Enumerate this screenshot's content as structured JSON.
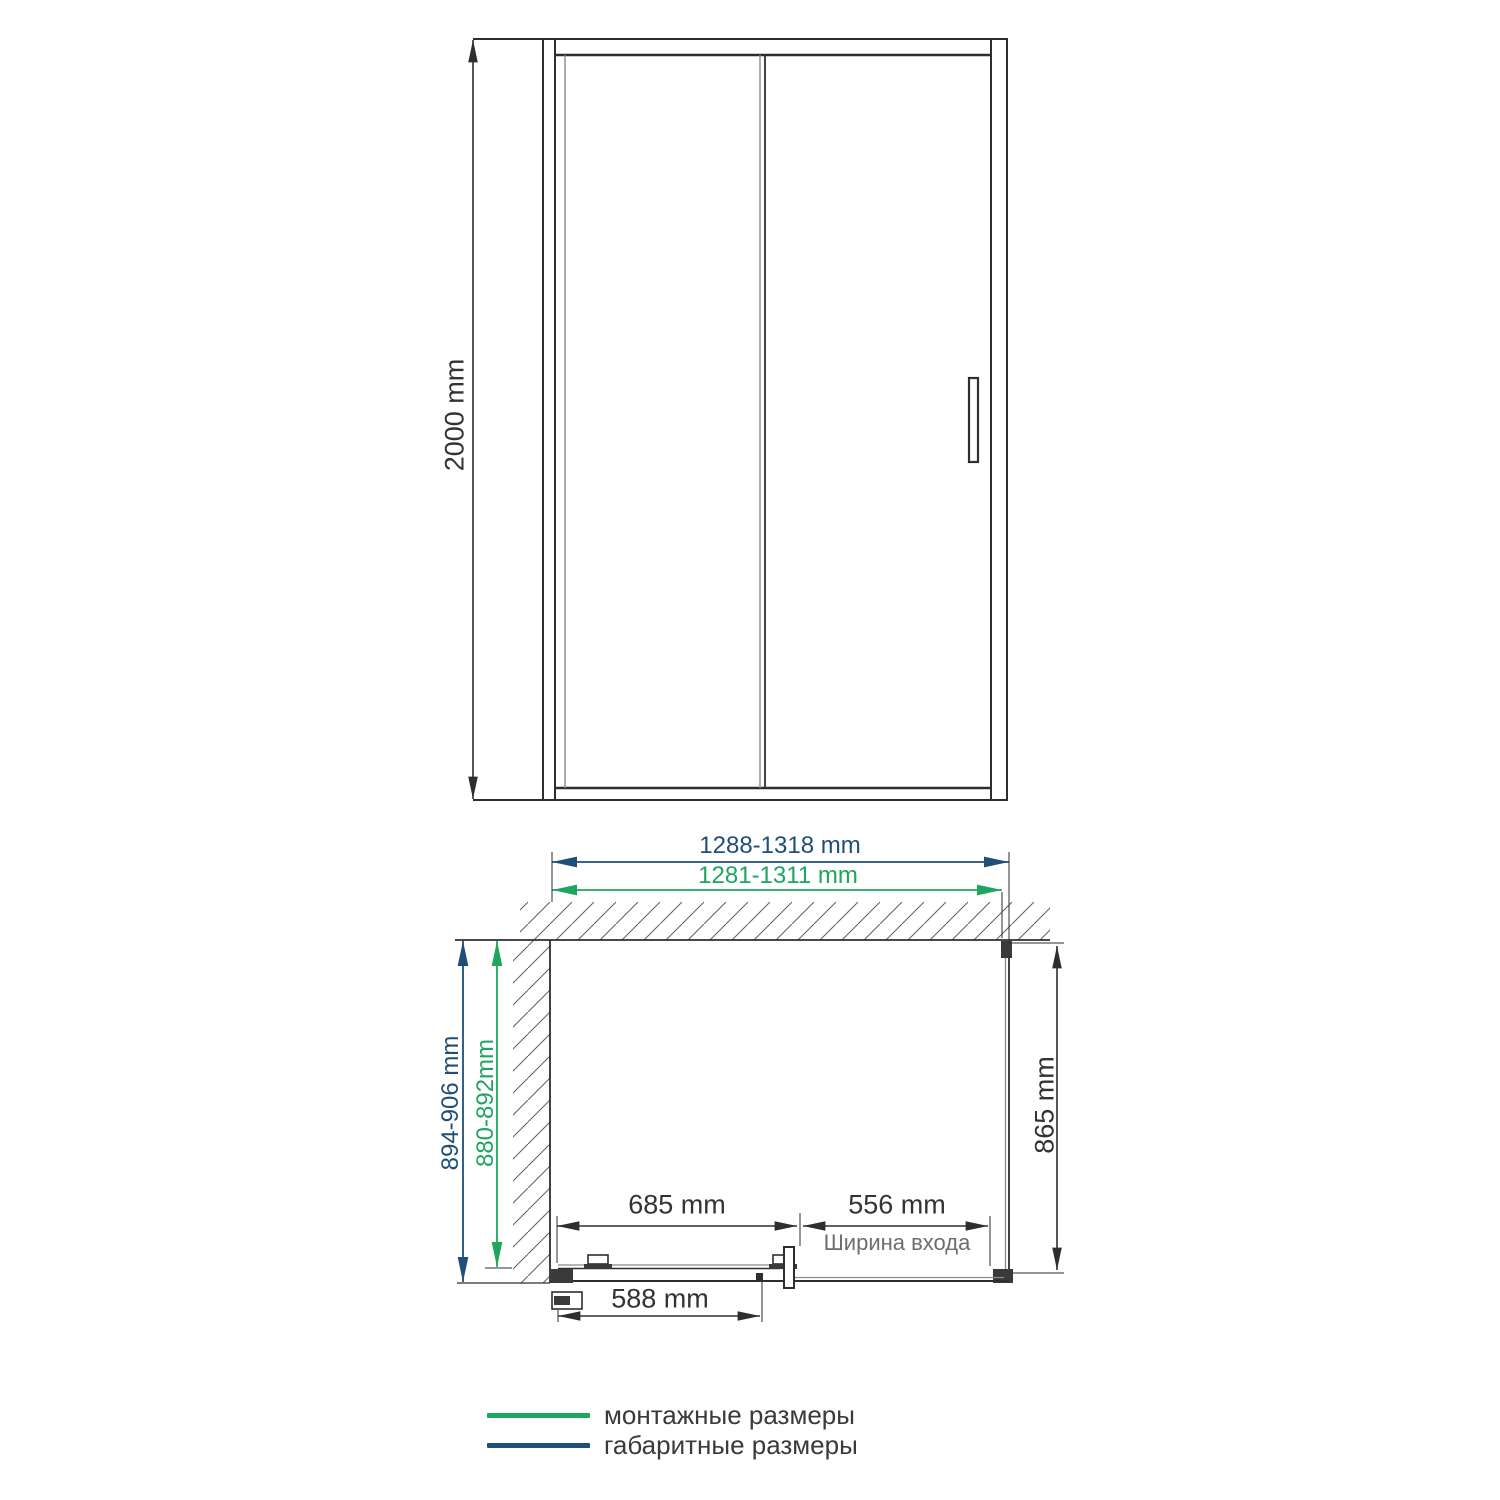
{
  "colors": {
    "overall": "#1F4E79",
    "mounting": "#1FA65E",
    "ink": "#2e2e2e",
    "muted": "#6e6e6e"
  },
  "front_view": {
    "height": "2000 mm"
  },
  "plan_view": {
    "overall_width": "1288-1318 mm",
    "mounting_width": "1281-1311 mm",
    "overall_depth": "894-906 mm",
    "mounting_depth": "880-892mm",
    "side_panel_depth": "865 mm",
    "door_width": "685 mm",
    "entry_width": "556 mm",
    "entry_caption": "Ширина входа",
    "glass_width": "588 mm"
  },
  "legend": {
    "items": [
      {
        "label": "монтажные размеры",
        "color": "#1FA65E"
      },
      {
        "label": "габаритные размеры",
        "color": "#1F4E79"
      }
    ]
  }
}
